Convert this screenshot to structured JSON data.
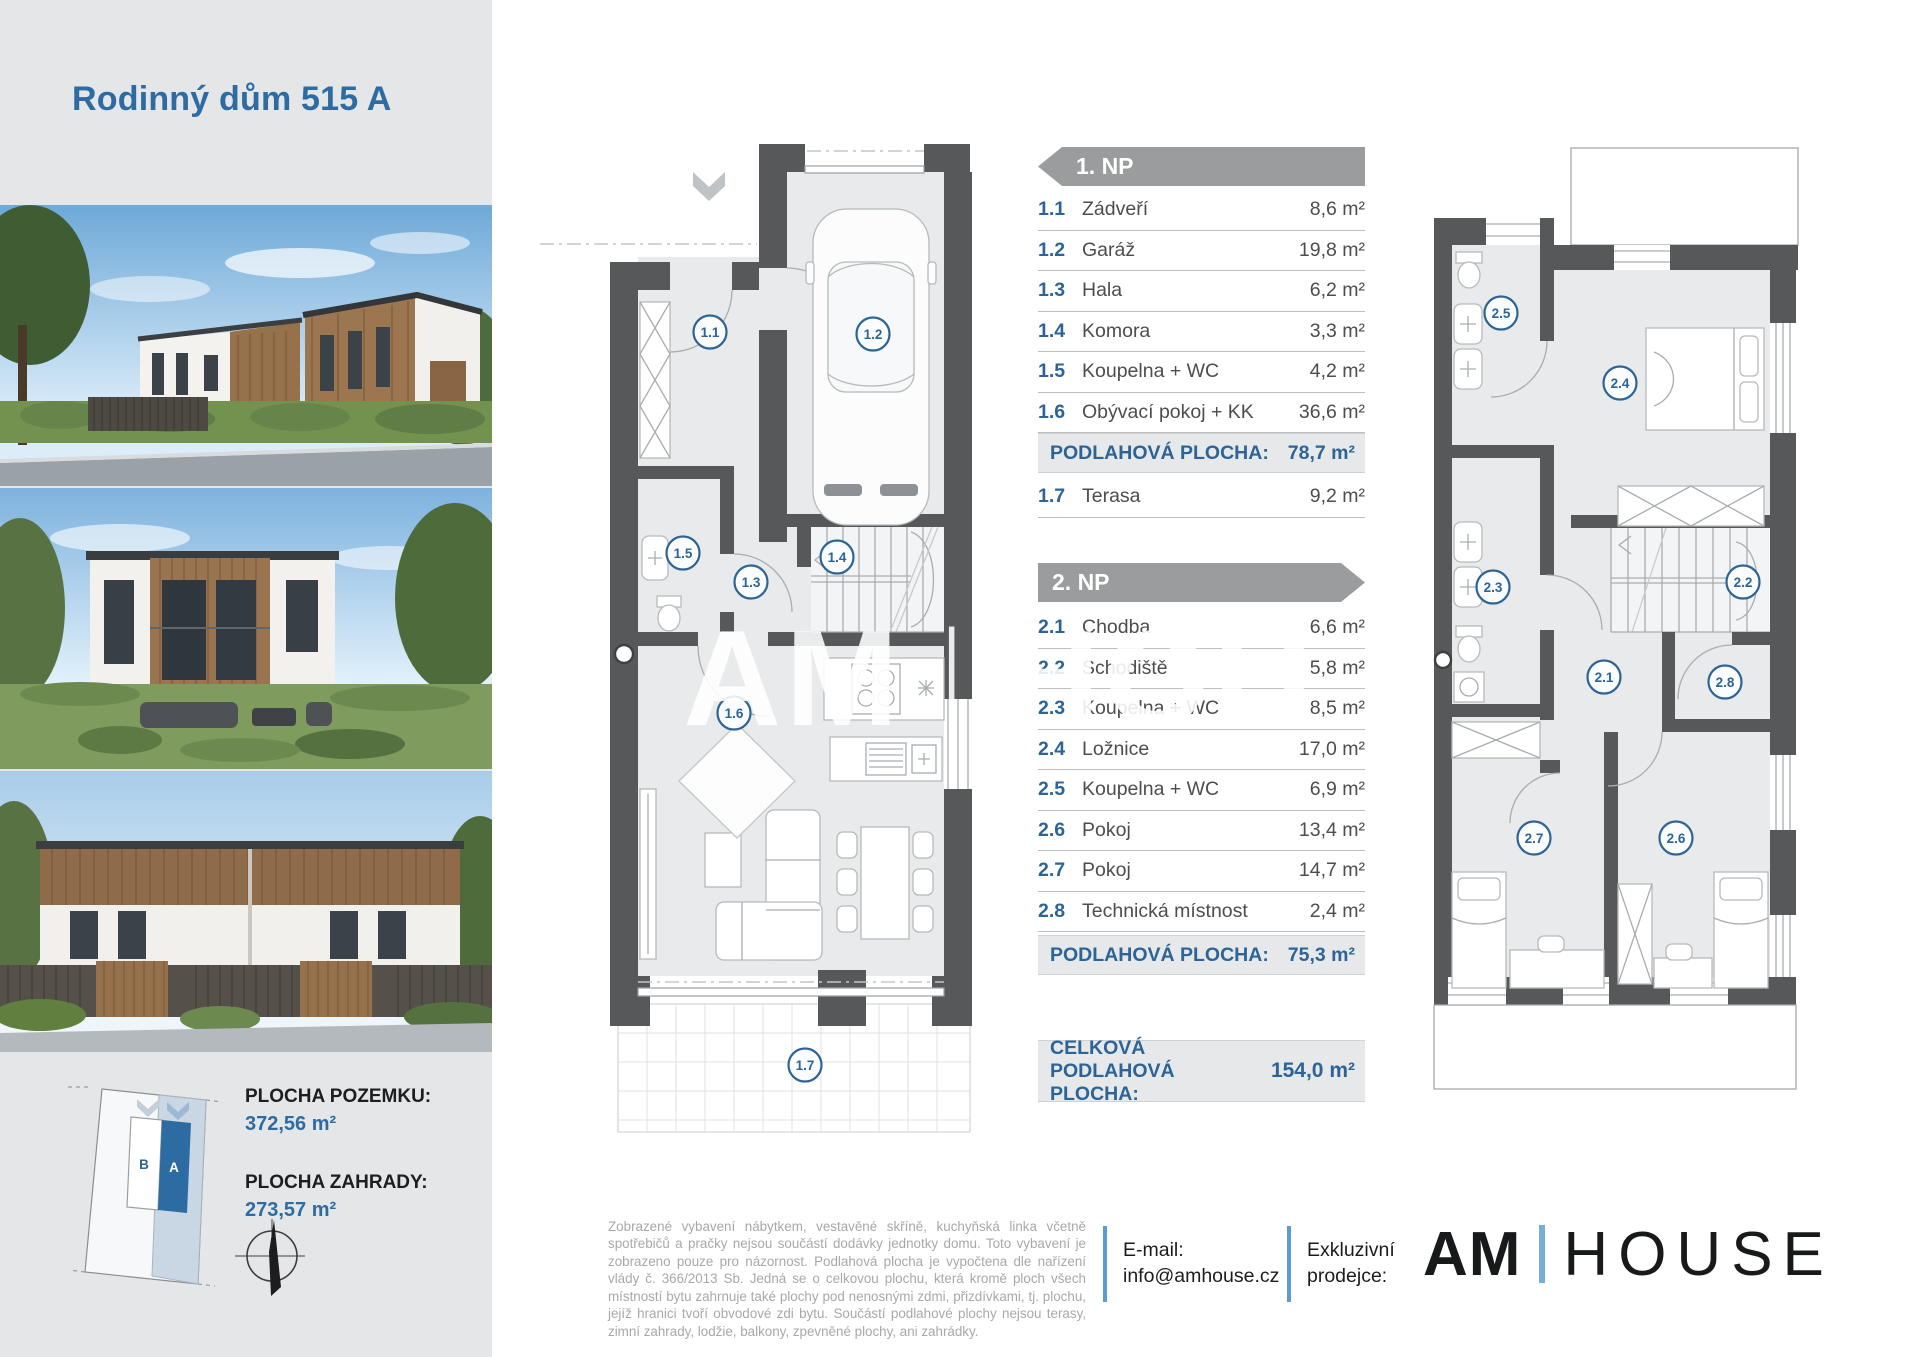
{
  "header": {
    "title": "Rodinný dům 515 A"
  },
  "watermark": {
    "left": "AM",
    "bar": "|",
    "right": "HOU"
  },
  "plan1": {
    "badges": [
      "1.1",
      "1.2",
      "1.3",
      "1.4",
      "1.5",
      "1.6",
      "1.7"
    ]
  },
  "plan2": {
    "badges": [
      "2.1",
      "2.2",
      "2.3",
      "2.4",
      "2.5",
      "2.6",
      "2.7",
      "2.8"
    ]
  },
  "floor1": {
    "banner": "1. NP",
    "rows": [
      {
        "num": "1.1",
        "label": "Zádveří",
        "area": "8,6 m²"
      },
      {
        "num": "1.2",
        "label": "Garáž",
        "area": "19,8 m²"
      },
      {
        "num": "1.3",
        "label": "Hala",
        "area": "6,2 m²"
      },
      {
        "num": "1.4",
        "label": "Komora",
        "area": "3,3 m²"
      },
      {
        "num": "1.5",
        "label": "Koupelna + WC",
        "area": "4,2 m²"
      },
      {
        "num": "1.6",
        "label": "Obývací pokoj + KK",
        "area": "36,6 m²"
      }
    ],
    "summary_label": "PODLAHOVÁ PLOCHA:",
    "summary_value": "78,7 m²",
    "terrace": {
      "num": "1.7",
      "label": "Terasa",
      "area": "9,2 m²"
    }
  },
  "floor2": {
    "banner": "2. NP",
    "rows": [
      {
        "num": "2.1",
        "label": "Chodba",
        "area": "6,6 m²"
      },
      {
        "num": "2.2",
        "label": "Schodiště",
        "area": "5,8 m²"
      },
      {
        "num": "2.3",
        "label": "Koupelna + WC",
        "area": "8,5 m²"
      },
      {
        "num": "2.4",
        "label": "Ložnice",
        "area": "17,0 m²"
      },
      {
        "num": "2.5",
        "label": "Koupelna + WC",
        "area": "6,9 m²"
      },
      {
        "num": "2.6",
        "label": "Pokoj",
        "area": "13,4 m²"
      },
      {
        "num": "2.7",
        "label": "Pokoj",
        "area": "14,7 m²"
      },
      {
        "num": "2.8",
        "label": "Technická místnost",
        "area": "2,4 m²"
      }
    ],
    "summary_label": "PODLAHOVÁ PLOCHA:",
    "summary_value": "75,3 m²"
  },
  "total": {
    "label": "CELKOVÁ PODLAHOVÁ PLOCHA:",
    "value": "154,0 m²"
  },
  "site": {
    "plot_label": "PLOCHA POZEMKU:",
    "plot_value": "372,56 m²",
    "garden_label": "PLOCHA ZAHRADY:",
    "garden_value": "273,57 m²",
    "unit_a": "A",
    "unit_b": "B"
  },
  "footer": {
    "disclaimer": "Zobrazené vybavení nábytkem, vestavěné skříně, kuchyňská linka včetně spotřebičů a pračky nejsou součástí dodávky jednotky domu. Toto vybavení je zobrazeno pouze pro názornost. Podlahová plocha je vypočtena dle nařízení vlády č. 366/2013 Sb. Jedná se o celkovou plochu, která kromě ploch všech místností bytu zahrnuje také plochy pod nenosnými zdmi, přizdívkami, tj. plochu, jejíž hranici tvoří obvodové zdi bytu. Součástí podlahové plochy nejsou terasy, zimní zahrady, lodžie, balkony, zpevněné plochy, ani zahrádky.",
    "email_label": "E-mail:",
    "email_value": "info@amhouse.cz",
    "exclusive_line1": "Exkluzivní",
    "exclusive_line2": "prodejce:",
    "logo_primary": "AM",
    "logo_secondary": "HOUSE"
  },
  "colors": {
    "accent_blue": "#2d6ca3",
    "table_blue": "#2c6497",
    "banner_gray": "#9b9c9e",
    "wall_gray": "#57585a",
    "floor_gray": "#e9eaec",
    "bar_blue": "#5b9bd5"
  }
}
